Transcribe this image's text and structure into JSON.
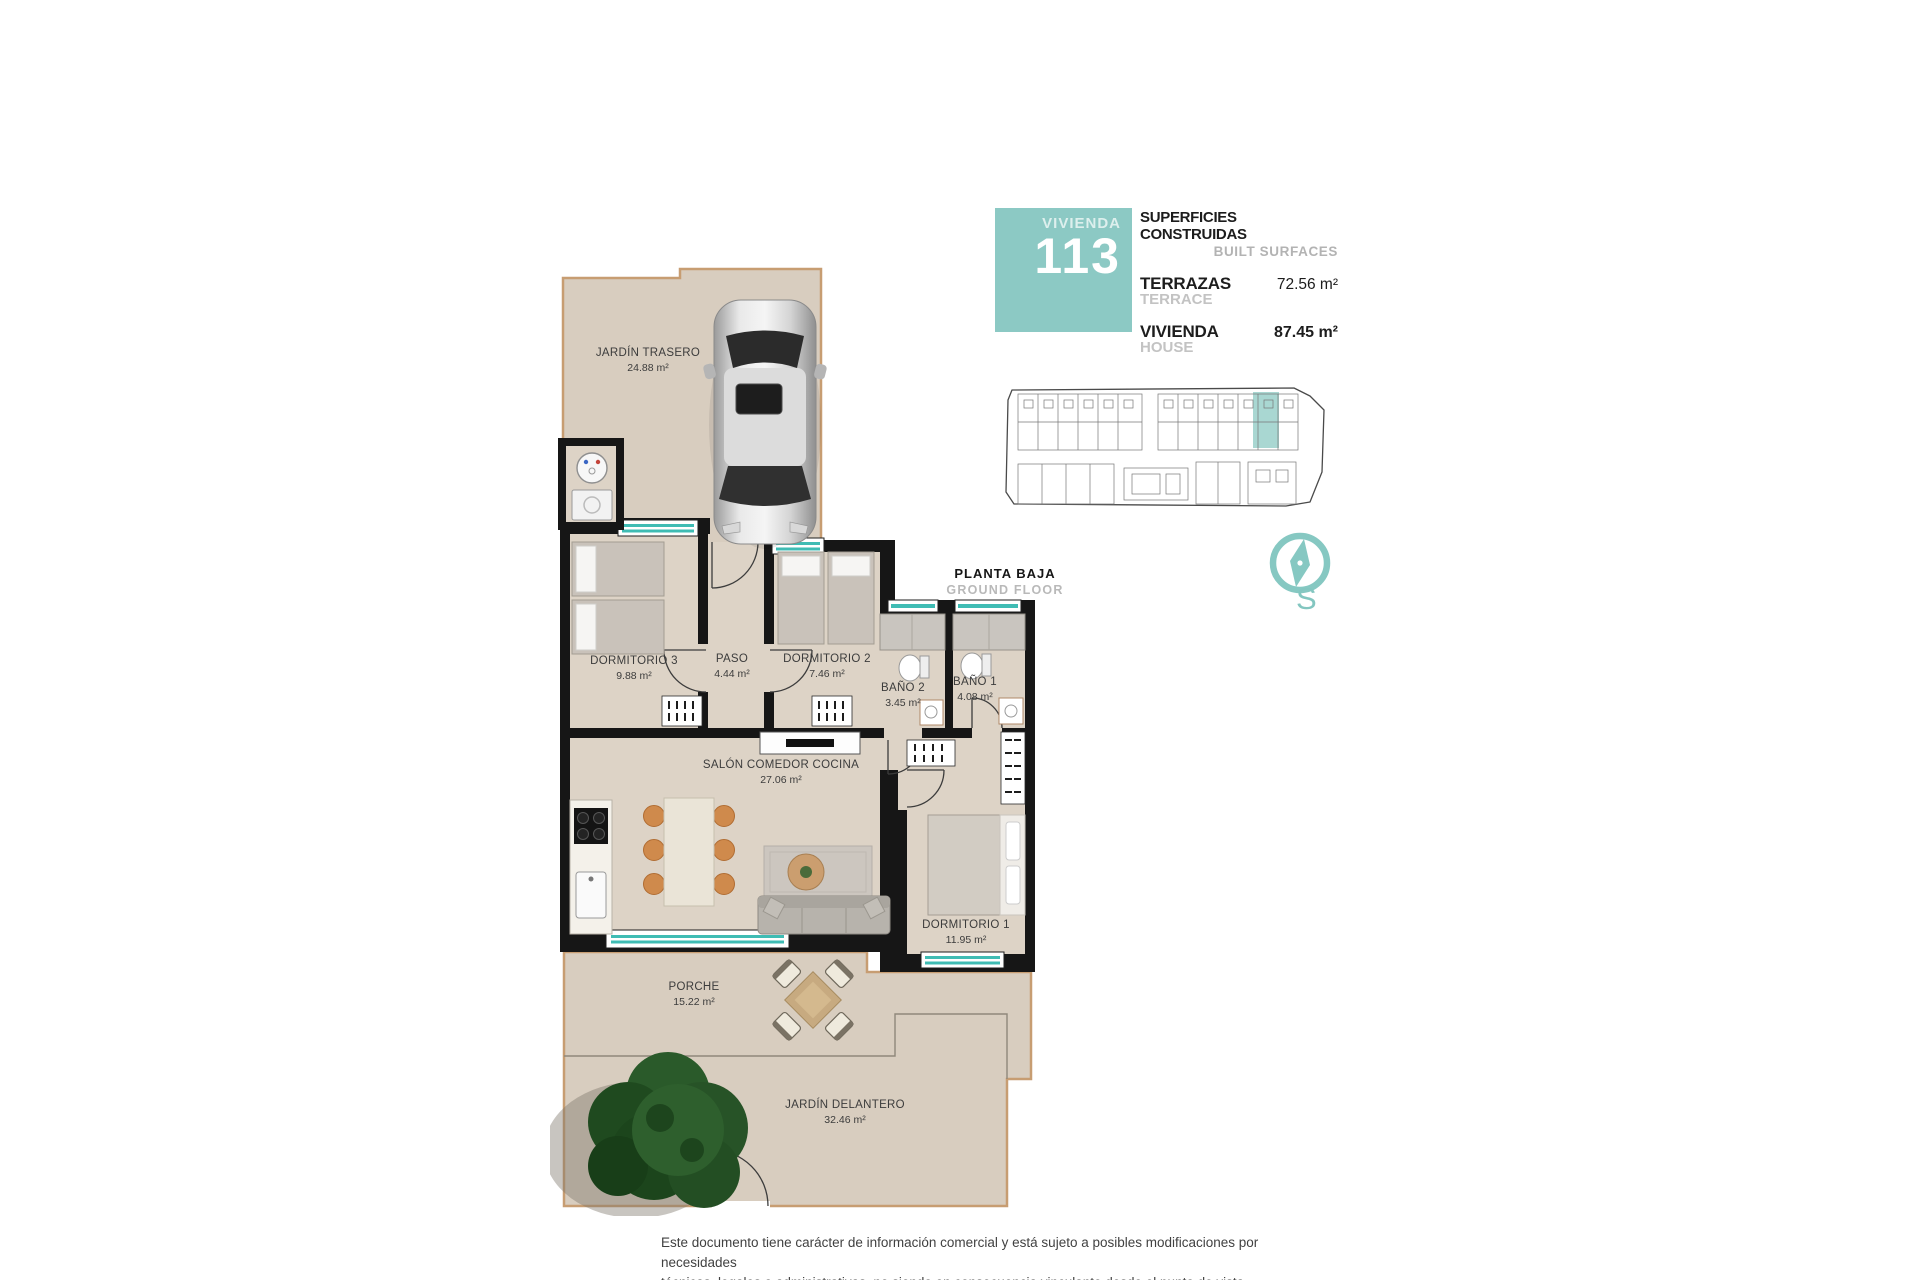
{
  "unit_card": {
    "vivienda_label": "VIVIENDA",
    "unit_number": "113",
    "surfaces_title": "SUPERFICIES CONSTRUIDAS",
    "surfaces_subtitle": "BUILT SURFACES",
    "rows": [
      {
        "label": "TERRAZAS",
        "sublabel": "TERRACE",
        "value": "72.56 m²"
      },
      {
        "label": "VIVIENDA",
        "sublabel": "HOUSE",
        "value": "87.45 m²"
      }
    ]
  },
  "floor_label": {
    "title": "PLANTA BAJA",
    "subtitle": "GROUND FLOOR"
  },
  "compass": {
    "letter": "S"
  },
  "rooms": [
    {
      "name": "JARDÍN TRASERO",
      "area": "24.88 m²"
    },
    {
      "name": "DORMITORIO 3",
      "area": "9.88 m²"
    },
    {
      "name": "PASO",
      "area": "4.44 m²"
    },
    {
      "name": "DORMITORIO 2",
      "area": "7.46 m²"
    },
    {
      "name": "BAÑO 2",
      "area": "3.45 m²"
    },
    {
      "name": "BAÑO 1",
      "area": "4.08 m²"
    },
    {
      "name": "SALÓN COMEDOR COCINA",
      "area": "27.06 m²"
    },
    {
      "name": "DORMITORIO 1",
      "area": "11.95 m²"
    },
    {
      "name": "PORCHE",
      "area": "15.22 m²"
    },
    {
      "name": "JARDÍN DELANTERO",
      "area": "32.46 m²"
    }
  ],
  "disclaimer": {
    "line1": "Este documento tiene carácter de información comercial y está sujeto a posibles modificaciones por necesidades",
    "line2": "técnicas, legales o administrativas, no siendo en consecuencia vinculante desde el punto de vista contractual."
  },
  "colors": {
    "accent_teal": "#8cc9c4",
    "window_teal": "#3fbcb4",
    "wall_black": "#161616",
    "floor_beige": "#ddd3c6",
    "garden_beige": "#d8cdbf",
    "border_tan": "#c79d72"
  }
}
